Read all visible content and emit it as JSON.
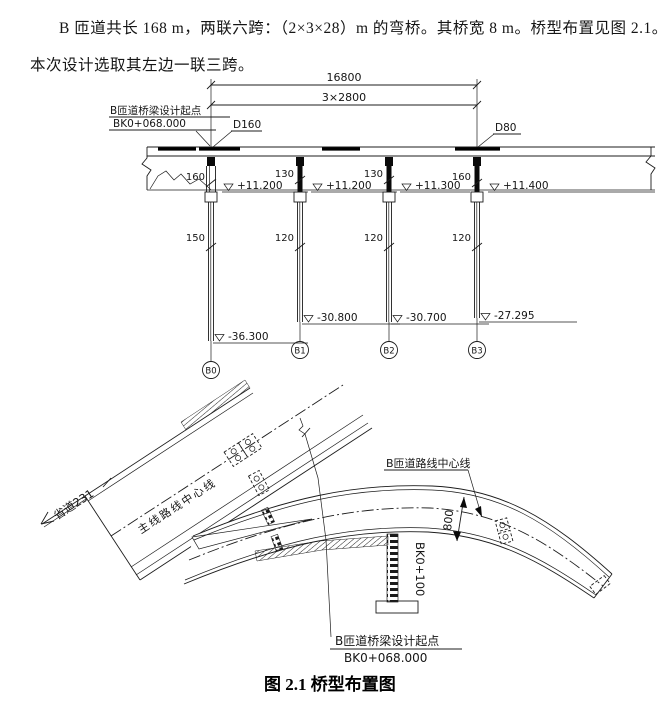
{
  "paragraph": {
    "line1": "B 匝道共长 168 m，两联六跨：（2×3×28）m 的弯桥。其桥宽 8 m。桥型布置见图 2.1。",
    "line2": "本次设计选取其左边一联三跨。"
  },
  "elevation": {
    "dim_total": "16800",
    "dim_spans": "3×2800",
    "start_point_label": "B匝道桥梁设计起点",
    "start_point_station": "BK0+068.000",
    "left_pier_diameter": "D160",
    "right_pier_diameter": "D80",
    "piers": [
      {
        "id": "B0",
        "cap_width": "160",
        "shaft_width": "150",
        "top_elevation": "+11.200",
        "bottom_elevation": "-36.300"
      },
      {
        "id": "B1",
        "cap_width": "130",
        "shaft_width": "120",
        "top_elevation": "+11.200",
        "bottom_elevation": "-30.800"
      },
      {
        "id": "B2",
        "cap_width": "130",
        "shaft_width": "120",
        "top_elevation": "+11.300",
        "bottom_elevation": "-30.700"
      },
      {
        "id": "B3",
        "cap_width": "160",
        "shaft_width": "120",
        "top_elevation": "+11.400",
        "bottom_elevation": "-27.295"
      }
    ]
  },
  "plan": {
    "main_road_label": "省道231",
    "main_centerline_label": "主线路线中心线",
    "ramp_centerline_label": "B匝道路线中心线",
    "width_dimension": "800",
    "station_label": "BK0+100",
    "start_point_label": "B匝道桥梁设计起点",
    "start_point_station": "BK0+068.000"
  },
  "caption": "图 2.1 桥型布置图"
}
